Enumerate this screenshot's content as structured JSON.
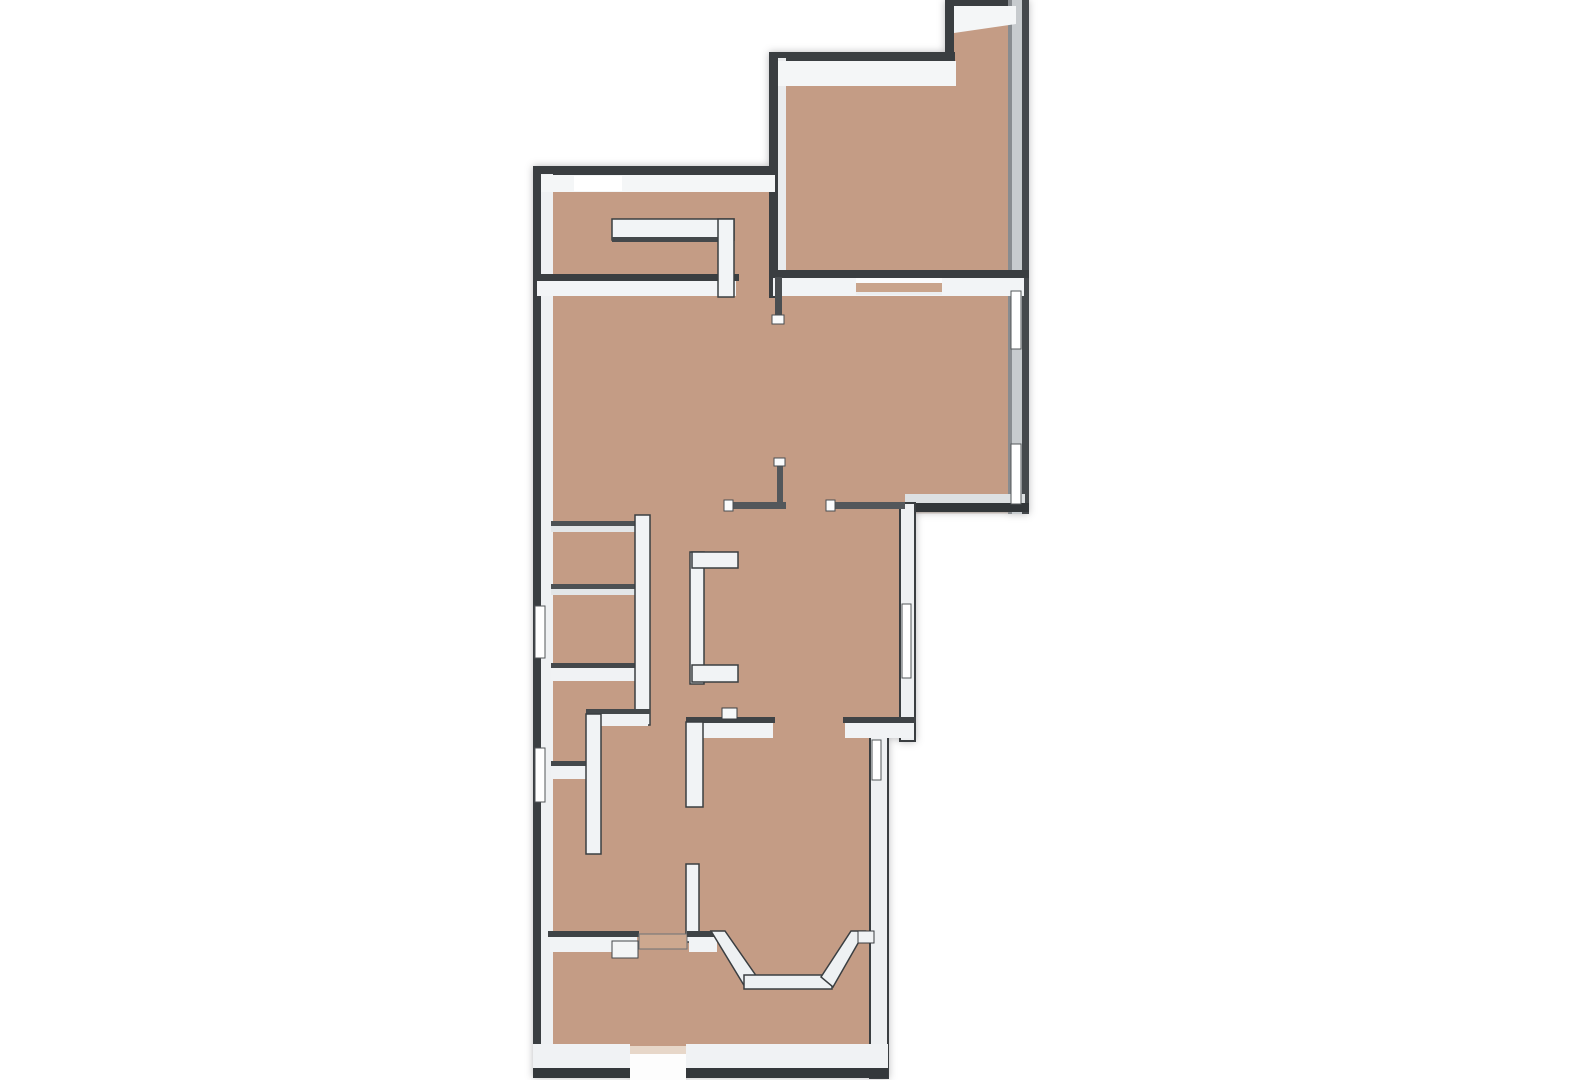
{
  "meta": {
    "description": "3D top-down floor plan rendering, tan floor with white-capped walls on a white background",
    "canvas": {
      "width": 1571,
      "height": 1080
    }
  },
  "palette": {
    "background": "#ffffff",
    "floor": "#c49c85",
    "floor_threshold": "#cda88f",
    "wall_face_bright": "#f4f6f7",
    "wall_face_light": "#f1f3f5",
    "wall_dark": "#3a3e41",
    "wall_dark_soft": "#4d5154",
    "east_wall_shaded": "#c7cbce",
    "window_glass": "#ffffff"
  },
  "floorplan": {
    "elements": [
      {
        "name": "floor-main",
        "shape": "polygon",
        "points": "540,170 775,170 775,56 948,56 948,2 1026,2 1026,512 906,512 906,724 882,724 882,1070 540,1070",
        "fill": "#c49c85"
      },
      {
        "name": "floor-edge-shade",
        "shape": "polygon",
        "points": "540,170 775,170 775,56 948,56 948,2 1026,2 1026,512 906,512 906,724 882,724 882,1070 540,1070",
        "fill": "none",
        "stroke": "rgba(90,55,35,0.25)",
        "sw": 3
      },
      {
        "name": "wall-spine-west",
        "shape": "rect",
        "x": 533,
        "y": 166,
        "w": 8,
        "h": 912,
        "fill": "#3a3e41"
      },
      {
        "name": "wall-spine-north-main",
        "shape": "rect",
        "x": 533,
        "y": 166,
        "w": 246,
        "h": 9,
        "fill": "#3a3e41"
      },
      {
        "name": "wall-spine-upper-right-west",
        "shape": "rect",
        "x": 769,
        "y": 52,
        "w": 9,
        "h": 246,
        "fill": "#3a3e41"
      },
      {
        "name": "wall-spine-upper-right-north",
        "shape": "rect",
        "x": 769,
        "y": 52,
        "w": 186,
        "h": 9,
        "fill": "#3a3e41"
      },
      {
        "name": "wall-spine-notch-west",
        "shape": "rect",
        "x": 945,
        "y": 0,
        "w": 9,
        "h": 58,
        "fill": "#3a3e41"
      },
      {
        "name": "wall-spine-notch-north",
        "shape": "rect",
        "x": 945,
        "y": 0,
        "w": 73,
        "h": 6,
        "fill": "#3a3e41"
      },
      {
        "name": "wall-east-body",
        "shape": "rect",
        "x": 1008,
        "y": 0,
        "w": 16,
        "h": 514,
        "fill": "#c7cbce"
      },
      {
        "name": "wall-east-inner-line",
        "shape": "rect",
        "x": 1008,
        "y": 0,
        "w": 4,
        "h": 514,
        "fill": "#888c90"
      },
      {
        "name": "wall-spine-east-outer",
        "shape": "rect",
        "x": 1022,
        "y": 0,
        "w": 7,
        "h": 514,
        "fill": "#45494c"
      },
      {
        "name": "wall-spine-upper-right-south",
        "shape": "rect",
        "x": 769,
        "y": 270,
        "w": 260,
        "h": 8,
        "fill": "#3a3e41"
      },
      {
        "name": "wall-face-right-ext-south",
        "shape": "rect",
        "x": 905,
        "y": 494,
        "w": 120,
        "h": 9,
        "fill": "#dde0e2"
      },
      {
        "name": "wall-spine-right-ext-south",
        "shape": "rect",
        "x": 903,
        "y": 503,
        "w": 126,
        "h": 9,
        "fill": "#33373a"
      },
      {
        "name": "wall-mid-right-west",
        "shape": "rect",
        "x": 900,
        "y": 503,
        "w": 15,
        "h": 238,
        "fill": "#eef0f2",
        "stroke": "#3a3e41",
        "sw": 2
      },
      {
        "name": "wall-lower-right-east",
        "shape": "rect",
        "x": 870,
        "y": 724,
        "w": 18,
        "h": 354,
        "fill": "#eef0f2",
        "stroke": "#3a3e41",
        "sw": 2
      },
      {
        "name": "wall-face-west",
        "shape": "rect",
        "x": 541,
        "y": 174,
        "w": 12,
        "h": 896,
        "fill": "#eff1f3"
      },
      {
        "name": "wall-face-north-main",
        "shape": "rect",
        "x": 541,
        "y": 175,
        "w": 234,
        "h": 17,
        "fill": "#f4f6f7"
      },
      {
        "name": "window-north-panel",
        "shape": "rect",
        "x": 574,
        "y": 176,
        "w": 48,
        "h": 15,
        "fill": "#ffffff"
      },
      {
        "name": "wall-face-upper-right-west",
        "shape": "rect",
        "x": 778,
        "y": 58,
        "w": 8,
        "h": 212,
        "fill": "#e9ebed"
      },
      {
        "name": "wall-face-upper-right-north",
        "shape": "rect",
        "x": 778,
        "y": 61,
        "w": 178,
        "h": 25,
        "fill": "#f4f6f7"
      },
      {
        "name": "wall-face-notch",
        "shape": "polygon",
        "points": "954,6 1016,6 1016,24 954,33",
        "fill": "#f4f6f7"
      },
      {
        "name": "wall-face-upper-right-south",
        "shape": "rect",
        "x": 773,
        "y": 278,
        "w": 251,
        "h": 18,
        "fill": "#f2f4f6"
      },
      {
        "name": "sliding-door-ledge",
        "shape": "rect",
        "x": 856,
        "y": 278,
        "w": 86,
        "h": 5,
        "fill": "#fafbfc"
      },
      {
        "name": "sliding-door-track",
        "shape": "rect",
        "x": 856,
        "y": 283,
        "w": 86,
        "h": 9,
        "fill": "#c9a48c"
      },
      {
        "name": "sliding-door-bottom-edge",
        "shape": "rect",
        "x": 856,
        "y": 292,
        "w": 86,
        "h": 3,
        "fill": "#eceef0"
      },
      {
        "name": "wall-spine-upper-left-south",
        "shape": "rect",
        "x": 533,
        "y": 274,
        "w": 206,
        "h": 7,
        "fill": "#3a3e41"
      },
      {
        "name": "wall-face-upper-left-south",
        "shape": "rect",
        "x": 537,
        "y": 281,
        "w": 199,
        "h": 15,
        "fill": "#f2f4f6"
      },
      {
        "name": "window-west-1",
        "shape": "rect",
        "x": 535,
        "y": 606,
        "w": 10,
        "h": 52,
        "fill": "#ffffff",
        "stroke": "#53575a",
        "sw": 1
      },
      {
        "name": "window-west-2",
        "shape": "rect",
        "x": 535,
        "y": 748,
        "w": 10,
        "h": 54,
        "fill": "#ffffff",
        "stroke": "#53575a",
        "sw": 1
      },
      {
        "name": "window-east-1",
        "shape": "rect",
        "x": 1011,
        "y": 291,
        "w": 10,
        "h": 58,
        "fill": "#ffffff",
        "stroke": "#53575a",
        "sw": 1
      },
      {
        "name": "window-east-2",
        "shape": "rect",
        "x": 1011,
        "y": 444,
        "w": 10,
        "h": 60,
        "fill": "#ffffff",
        "stroke": "#53575a",
        "sw": 1
      },
      {
        "name": "window-mid-right",
        "shape": "rect",
        "x": 902,
        "y": 604,
        "w": 9,
        "h": 74,
        "fill": "#ffffff",
        "stroke": "#53575a",
        "sw": 1
      },
      {
        "name": "window-lower-right",
        "shape": "rect",
        "x": 872,
        "y": 740,
        "w": 9,
        "h": 40,
        "fill": "#ffffff",
        "stroke": "#53575a",
        "sw": 1
      },
      {
        "name": "upper-left-inner-band",
        "shape": "rect",
        "x": 612,
        "y": 219,
        "w": 122,
        "h": 21,
        "fill": "#f2f4f6",
        "stroke": "#3a3e41",
        "sw": 1.5
      },
      {
        "name": "upper-left-inner-band-edge",
        "shape": "rect",
        "x": 612,
        "y": 237,
        "w": 122,
        "h": 5,
        "fill": "#44484b"
      },
      {
        "name": "upper-left-inner-vertical",
        "shape": "rect",
        "x": 718,
        "y": 219,
        "w": 16,
        "h": 78,
        "fill": "#f2f4f6",
        "stroke": "#3a3e41",
        "sw": 1.5
      },
      {
        "name": "partition-h1-edge",
        "shape": "rect",
        "x": 551,
        "y": 521,
        "w": 88,
        "h": 5,
        "fill": "#4d5154"
      },
      {
        "name": "partition-h1-face",
        "shape": "rect",
        "x": 551,
        "y": 526,
        "w": 88,
        "h": 6,
        "fill": "#e3e6e8"
      },
      {
        "name": "partition-h2-edge",
        "shape": "rect",
        "x": 551,
        "y": 584,
        "w": 88,
        "h": 5,
        "fill": "#4d5154"
      },
      {
        "name": "partition-h2-face",
        "shape": "rect",
        "x": 551,
        "y": 589,
        "w": 88,
        "h": 6,
        "fill": "#e3e6e8"
      },
      {
        "name": "wall-h3-edge",
        "shape": "rect",
        "x": 551,
        "y": 663,
        "w": 88,
        "h": 5,
        "fill": "#44484b"
      },
      {
        "name": "wall-h3-face",
        "shape": "rect",
        "x": 551,
        "y": 668,
        "w": 88,
        "h": 13,
        "fill": "#f0f2f4"
      },
      {
        "name": "wall-h4-edge",
        "shape": "rect",
        "x": 551,
        "y": 761,
        "w": 42,
        "h": 5,
        "fill": "#44484b"
      },
      {
        "name": "wall-h4-face",
        "shape": "rect",
        "x": 551,
        "y": 766,
        "w": 42,
        "h": 13,
        "fill": "#f0f2f4"
      },
      {
        "name": "wall-vertical-1",
        "shape": "rect",
        "x": 635,
        "y": 515,
        "w": 15,
        "h": 210,
        "fill": "#f1f3f5",
        "stroke": "#3a3e41",
        "sw": 1.5
      },
      {
        "name": "wall-jog-edge",
        "shape": "rect",
        "x": 586,
        "y": 709,
        "w": 64,
        "h": 5,
        "fill": "#44484b"
      },
      {
        "name": "wall-jog-face",
        "shape": "rect",
        "x": 586,
        "y": 714,
        "w": 62,
        "h": 12,
        "fill": "#f0f2f4"
      },
      {
        "name": "wall-vertical-2",
        "shape": "rect",
        "x": 586,
        "y": 714,
        "w": 15,
        "h": 140,
        "fill": "#f1f3f5",
        "stroke": "#3a3e41",
        "sw": 1.5
      },
      {
        "name": "chimney-bracket-vertical",
        "shape": "rect",
        "x": 690,
        "y": 552,
        "w": 14,
        "h": 132,
        "fill": "#f1f3f5",
        "stroke": "#3a3e41",
        "sw": 1.5
      },
      {
        "name": "chimney-bracket-top-arm",
        "shape": "rect",
        "x": 692,
        "y": 552,
        "w": 46,
        "h": 16,
        "fill": "#f1f3f5",
        "stroke": "#3a3e41",
        "sw": 1.5
      },
      {
        "name": "chimney-bracket-bottom-arm",
        "shape": "rect",
        "x": 692,
        "y": 665,
        "w": 46,
        "h": 17,
        "fill": "#f1f3f5",
        "stroke": "#3a3e41",
        "sw": 1.5
      },
      {
        "name": "wall-y722-left-edge",
        "shape": "rect",
        "x": 686,
        "y": 717,
        "w": 89,
        "h": 6,
        "fill": "#3f4346"
      },
      {
        "name": "wall-y722-left-face",
        "shape": "rect",
        "x": 688,
        "y": 723,
        "w": 85,
        "h": 15,
        "fill": "#f1f3f5"
      },
      {
        "name": "wall-y722-right-edge",
        "shape": "rect",
        "x": 843,
        "y": 717,
        "w": 73,
        "h": 6,
        "fill": "#3f4346"
      },
      {
        "name": "wall-y722-right-face",
        "shape": "rect",
        "x": 845,
        "y": 723,
        "w": 69,
        "h": 15,
        "fill": "#f1f3f5"
      },
      {
        "name": "wall-mid-vertical-arm",
        "shape": "rect",
        "x": 686,
        "y": 722,
        "w": 17,
        "h": 85,
        "fill": "#f1f3f5",
        "stroke": "#3a3e41",
        "sw": 1.5
      },
      {
        "name": "wall-tiny-stub",
        "shape": "rect",
        "x": 722,
        "y": 708,
        "w": 15,
        "h": 11,
        "fill": "#f6f8f9",
        "stroke": "#3a3e41",
        "sw": 1
      },
      {
        "name": "wall-stub-lower",
        "shape": "rect",
        "x": 686,
        "y": 864,
        "w": 13,
        "h": 78,
        "fill": "#f1f3f5",
        "stroke": "#3a3e41",
        "sw": 1.5
      },
      {
        "name": "railing-l-horizontal",
        "shape": "rect",
        "x": 727,
        "y": 502,
        "w": 59,
        "h": 7,
        "fill": "#53575b"
      },
      {
        "name": "railing-l-horizontal-cap",
        "shape": "rect",
        "x": 724,
        "y": 500,
        "w": 9,
        "h": 11,
        "fill": "#fafbfc",
        "stroke": "#4a4e51",
        "sw": 1
      },
      {
        "name": "railing-l-vertical",
        "shape": "rect",
        "x": 777,
        "y": 461,
        "w": 6,
        "h": 48,
        "fill": "#53575b"
      },
      {
        "name": "railing-l-vertical-cap",
        "shape": "rect",
        "x": 774,
        "y": 458,
        "w": 11,
        "h": 8,
        "fill": "#fafbfc",
        "stroke": "#4a4e51",
        "sw": 1
      },
      {
        "name": "railing-spur",
        "shape": "rect",
        "x": 829,
        "y": 502,
        "w": 76,
        "h": 7,
        "fill": "#53575b"
      },
      {
        "name": "railing-spur-cap",
        "shape": "rect",
        "x": 826,
        "y": 500,
        "w": 9,
        "h": 11,
        "fill": "#fafbfc",
        "stroke": "#4a4e51",
        "sw": 1
      },
      {
        "name": "railing-upper-stub",
        "shape": "rect",
        "x": 775,
        "y": 277,
        "w": 7,
        "h": 40,
        "fill": "#4a4e51"
      },
      {
        "name": "railing-upper-stub-cap",
        "shape": "rect",
        "x": 772,
        "y": 315,
        "w": 12,
        "h": 9,
        "fill": "#fafbfc",
        "stroke": "#4a4e51",
        "sw": 1
      },
      {
        "name": "wall-south-bay-left-edge",
        "shape": "rect",
        "x": 548,
        "y": 931,
        "w": 91,
        "h": 6,
        "fill": "#3f4346"
      },
      {
        "name": "wall-south-bay-left-face",
        "shape": "rect",
        "x": 550,
        "y": 937,
        "w": 87,
        "h": 15,
        "fill": "#f1f3f5"
      },
      {
        "name": "wall-pier-stub",
        "shape": "rect",
        "x": 612,
        "y": 941,
        "w": 26,
        "h": 17,
        "fill": "#f3f5f6",
        "stroke": "#44484b",
        "sw": 1
      },
      {
        "name": "door-threshold-south",
        "shape": "rect",
        "x": 639,
        "y": 934,
        "w": 48,
        "h": 15,
        "fill": "#cda88f",
        "stroke": "#6e7276",
        "sw": 1
      },
      {
        "name": "wall-south-bay-mid-edge",
        "shape": "rect",
        "x": 687,
        "y": 931,
        "w": 31,
        "h": 6,
        "fill": "#3f4346"
      },
      {
        "name": "wall-south-bay-mid-face",
        "shape": "rect",
        "x": 689,
        "y": 937,
        "w": 28,
        "h": 15,
        "fill": "#f1f3f5"
      },
      {
        "name": "bay-window-left",
        "shape": "polygon",
        "points": "711,931 725,931 757,977 745,987",
        "fill": "#eef1f3",
        "stroke": "#3a3e41",
        "sw": 1.5
      },
      {
        "name": "bay-window-bottom",
        "shape": "rect",
        "x": 744,
        "y": 975,
        "w": 88,
        "h": 14,
        "fill": "#eef1f3",
        "stroke": "#3a3e41",
        "sw": 1.5
      },
      {
        "name": "bay-window-right",
        "shape": "polygon",
        "points": "851,931 865,931 833,987 821,977",
        "fill": "#eef1f3",
        "stroke": "#3a3e41",
        "sw": 1.5
      },
      {
        "name": "bay-right-link",
        "shape": "rect",
        "x": 858,
        "y": 931,
        "w": 16,
        "h": 12,
        "fill": "#f1f3f5",
        "stroke": "#3a3e41",
        "sw": 1
      },
      {
        "name": "wall-face-bottom-left",
        "shape": "rect",
        "x": 533,
        "y": 1044,
        "w": 97,
        "h": 26,
        "fill": "#f0f2f4"
      },
      {
        "name": "wall-face-bottom-right",
        "shape": "rect",
        "x": 686,
        "y": 1044,
        "w": 202,
        "h": 26,
        "fill": "#f0f2f4"
      },
      {
        "name": "entry-gap-threshold",
        "shape": "rect",
        "x": 630,
        "y": 1046,
        "w": 56,
        "h": 8,
        "fill": "#e7d7c9"
      },
      {
        "name": "entry-gap-outside",
        "shape": "rect",
        "x": 630,
        "y": 1054,
        "w": 56,
        "h": 26,
        "fill": "#fdfdfd"
      },
      {
        "name": "wall-spine-bottom-left",
        "shape": "rect",
        "x": 533,
        "y": 1068,
        "w": 97,
        "h": 10,
        "fill": "#34383b"
      },
      {
        "name": "wall-spine-bottom-right",
        "shape": "rect",
        "x": 686,
        "y": 1068,
        "w": 202,
        "h": 10,
        "fill": "#34383b"
      }
    ]
  }
}
